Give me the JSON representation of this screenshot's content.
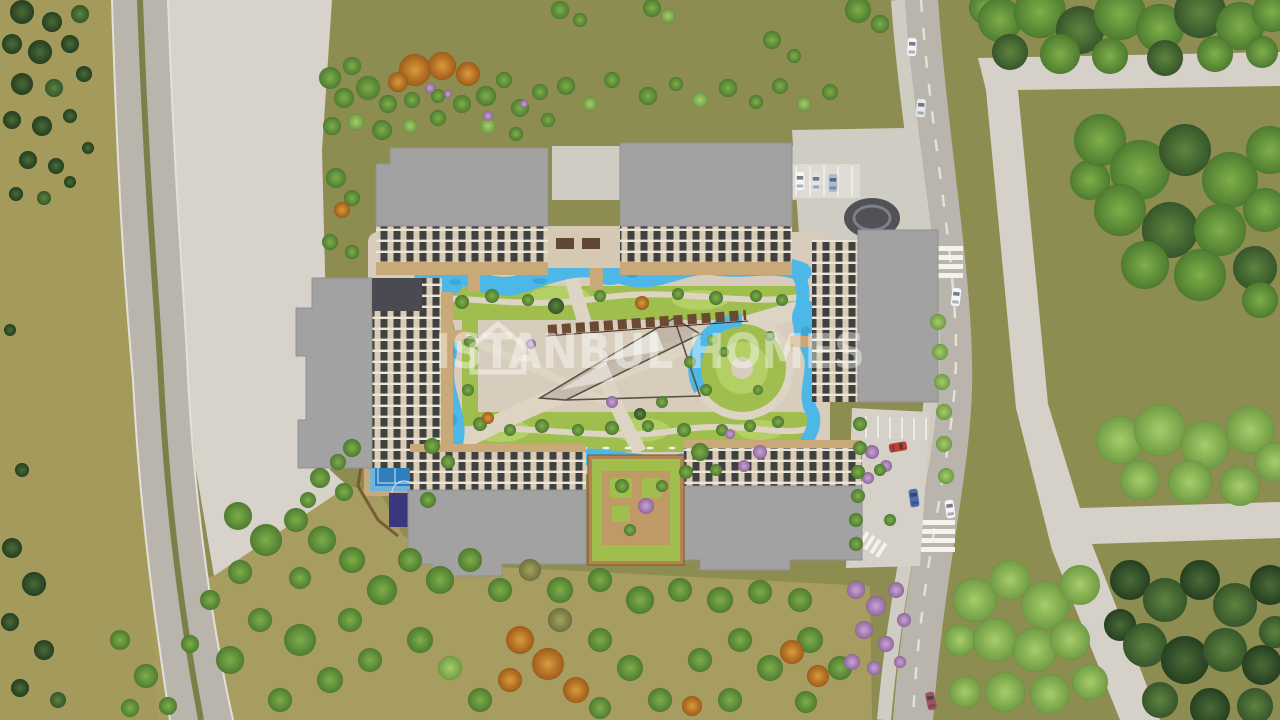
{
  "watermark": {
    "text": "ISTANBUL HOMES",
    "logo": "house-outline-icon"
  },
  "colors": {
    "ground": "#8d8c51",
    "groundLeft": "#a39a5c",
    "groundTan": "#a89d61",
    "plaza": "#d7d3ca",
    "road": "#b9b5ad",
    "roadEdge": "#e3e0d8",
    "median": "#7c7f48",
    "path": "#d5d1c9",
    "pavement": "#cfccc4",
    "parking": "#dedbd3",
    "courtyard": "#d8cdbc",
    "courtPath": "#ddd4c4",
    "lawn": "#9fbe4e",
    "lawnLight": "#b4cf66",
    "pool": "#4db8e8",
    "poolDeep": "#2e8fc4",
    "deck": "#c9a977",
    "roof": "#a2a2a2",
    "roofDark": "#4a4a52",
    "facade": "#d8ccb6",
    "facadeGlass": "#3f4140",
    "slab": "#ece4d4",
    "cabana": "#6a4a32",
    "circleDark": "#515257",
    "tennisOuter": "#6db5dd",
    "tennisInner": "#2f7fbd",
    "sport": "#3a3780",
    "white": "#f4f2ec",
    "wm": "rgba(255,255,255,0.42)"
  },
  "scene": {
    "trees": [
      [
        22,
        12,
        12,
        "c"
      ],
      [
        52,
        22,
        10,
        "c"
      ],
      [
        80,
        14,
        9,
        "dg"
      ],
      [
        12,
        44,
        10,
        "c"
      ],
      [
        40,
        52,
        12,
        "c"
      ],
      [
        70,
        44,
        9,
        "c"
      ],
      [
        22,
        84,
        11,
        "c"
      ],
      [
        54,
        88,
        9,
        "dg"
      ],
      [
        84,
        74,
        8,
        "c"
      ],
      [
        12,
        120,
        9,
        "c"
      ],
      [
        42,
        126,
        10,
        "c"
      ],
      [
        70,
        116,
        7,
        "c"
      ],
      [
        28,
        160,
        9,
        "c"
      ],
      [
        56,
        166,
        8,
        "c"
      ],
      [
        16,
        194,
        7,
        "c"
      ],
      [
        44,
        198,
        7,
        "dg"
      ],
      [
        70,
        182,
        6,
        "c"
      ],
      [
        88,
        148,
        6,
        "c"
      ],
      [
        10,
        330,
        6,
        "c"
      ],
      [
        22,
        470,
        7,
        "c"
      ],
      [
        12,
        548,
        10,
        "c"
      ],
      [
        34,
        584,
        12,
        "c"
      ],
      [
        10,
        622,
        9,
        "c"
      ],
      [
        44,
        650,
        10,
        "c"
      ],
      [
        20,
        688,
        9,
        "c"
      ],
      [
        58,
        700,
        8,
        "dg"
      ],
      [
        120,
        640,
        10,
        "g"
      ],
      [
        146,
        676,
        12,
        "g"
      ],
      [
        130,
        708,
        9,
        "g"
      ],
      [
        168,
        706,
        9,
        "g"
      ],
      [
        415,
        70,
        16,
        "o"
      ],
      [
        442,
        66,
        14,
        "o"
      ],
      [
        468,
        74,
        12,
        "o"
      ],
      [
        398,
        82,
        10,
        "o"
      ],
      [
        330,
        78,
        11,
        "g"
      ],
      [
        352,
        66,
        9,
        "g"
      ],
      [
        344,
        98,
        10,
        "g"
      ],
      [
        368,
        88,
        12,
        "g"
      ],
      [
        388,
        104,
        9,
        "g"
      ],
      [
        412,
        100,
        8,
        "g"
      ],
      [
        438,
        96,
        7,
        "g"
      ],
      [
        332,
        126,
        9,
        "g"
      ],
      [
        356,
        122,
        8,
        "lg"
      ],
      [
        382,
        130,
        10,
        "g"
      ],
      [
        410,
        126,
        7,
        "lg"
      ],
      [
        438,
        118,
        8,
        "g"
      ],
      [
        462,
        104,
        9,
        "g"
      ],
      [
        486,
        96,
        10,
        "g"
      ],
      [
        504,
        80,
        8,
        "g"
      ],
      [
        520,
        108,
        9,
        "g"
      ],
      [
        488,
        126,
        8,
        "lg"
      ],
      [
        516,
        134,
        7,
        "g"
      ],
      [
        540,
        92,
        8,
        "g"
      ],
      [
        548,
        120,
        7,
        "g"
      ],
      [
        430,
        88,
        5,
        "p"
      ],
      [
        448,
        94,
        4,
        "p"
      ],
      [
        488,
        116,
        5,
        "p"
      ],
      [
        524,
        104,
        4,
        "p"
      ],
      [
        566,
        86,
        9,
        "g"
      ],
      [
        590,
        104,
        7,
        "lg"
      ],
      [
        612,
        80,
        8,
        "g"
      ],
      [
        648,
        96,
        9,
        "g"
      ],
      [
        676,
        84,
        7,
        "g"
      ],
      [
        700,
        100,
        8,
        "lg"
      ],
      [
        728,
        88,
        9,
        "g"
      ],
      [
        756,
        102,
        7,
        "g"
      ],
      [
        780,
        86,
        8,
        "g"
      ],
      [
        804,
        104,
        7,
        "lg"
      ],
      [
        830,
        92,
        8,
        "g"
      ],
      [
        560,
        10,
        9,
        "g"
      ],
      [
        580,
        20,
        7,
        "g"
      ],
      [
        652,
        8,
        9,
        "g"
      ],
      [
        668,
        16,
        7,
        "lg"
      ],
      [
        858,
        10,
        13,
        "g"
      ],
      [
        880,
        24,
        9,
        "g"
      ],
      [
        772,
        40,
        9,
        "g"
      ],
      [
        794,
        56,
        7,
        "g"
      ],
      [
        336,
        178,
        10,
        "g"
      ],
      [
        352,
        198,
        8,
        "g"
      ],
      [
        342,
        210,
        8,
        "o"
      ],
      [
        330,
        242,
        8,
        "g"
      ],
      [
        352,
        252,
        7,
        "g"
      ],
      [
        320,
        478,
        10,
        "g"
      ],
      [
        344,
        492,
        9,
        "g"
      ],
      [
        308,
        500,
        8,
        "g"
      ],
      [
        462,
        302,
        7,
        "g"
      ],
      [
        492,
        296,
        7,
        "g"
      ],
      [
        528,
        300,
        6,
        "g"
      ],
      [
        556,
        306,
        8,
        "dg"
      ],
      [
        600,
        296,
        6,
        "g"
      ],
      [
        642,
        303,
        7,
        "o"
      ],
      [
        678,
        294,
        6,
        "g"
      ],
      [
        716,
        298,
        7,
        "g"
      ],
      [
        756,
        296,
        6,
        "g"
      ],
      [
        782,
        300,
        6,
        "g"
      ],
      [
        480,
        424,
        7,
        "g"
      ],
      [
        510,
        430,
        6,
        "g"
      ],
      [
        542,
        426,
        7,
        "g"
      ],
      [
        578,
        430,
        6,
        "g"
      ],
      [
        612,
        428,
        7,
        "g"
      ],
      [
        648,
        426,
        6,
        "g"
      ],
      [
        684,
        430,
        7,
        "g"
      ],
      [
        722,
        430,
        6,
        "g"
      ],
      [
        750,
        426,
        6,
        "g"
      ],
      [
        778,
        422,
        6,
        "g"
      ],
      [
        690,
        362,
        6,
        "g"
      ],
      [
        706,
        390,
        6,
        "g"
      ],
      [
        662,
        402,
        6,
        "g"
      ],
      [
        470,
        342,
        6,
        "g"
      ],
      [
        468,
        390,
        6,
        "g"
      ],
      [
        488,
        418,
        6,
        "o"
      ],
      [
        612,
        402,
        6,
        "p"
      ],
      [
        531,
        344,
        5,
        "p"
      ],
      [
        730,
        434,
        5,
        "p"
      ],
      [
        770,
        336,
        5,
        "g"
      ],
      [
        712,
        340,
        5,
        "lg"
      ],
      [
        640,
        414,
        6,
        "dg"
      ],
      [
        724,
        352,
        5,
        "g"
      ],
      [
        758,
        390,
        5,
        "g"
      ],
      [
        622,
        486,
        7,
        "g"
      ],
      [
        646,
        506,
        8,
        "p"
      ],
      [
        630,
        530,
        6,
        "g"
      ],
      [
        662,
        486,
        6,
        "g"
      ],
      [
        352,
        448,
        9,
        "g"
      ],
      [
        338,
        462,
        8,
        "g"
      ],
      [
        432,
        446,
        8,
        "g"
      ],
      [
        448,
        462,
        7,
        "g"
      ],
      [
        428,
        500,
        8,
        "g"
      ],
      [
        872,
        452,
        7,
        "p"
      ],
      [
        886,
        466,
        6,
        "p"
      ],
      [
        868,
        478,
        6,
        "p"
      ],
      [
        760,
        452,
        7,
        "p"
      ],
      [
        744,
        466,
        6,
        "p"
      ],
      [
        700,
        452,
        9,
        "g"
      ],
      [
        686,
        472,
        7,
        "g"
      ],
      [
        716,
        470,
        6,
        "g"
      ],
      [
        938,
        322,
        8,
        "lg"
      ],
      [
        940,
        352,
        8,
        "lg"
      ],
      [
        942,
        382,
        8,
        "lg"
      ],
      [
        944,
        412,
        8,
        "lg"
      ],
      [
        944,
        444,
        8,
        "lg"
      ],
      [
        946,
        476,
        8,
        "lg"
      ],
      [
        860,
        424,
        7,
        "g"
      ],
      [
        860,
        448,
        7,
        "g"
      ],
      [
        858,
        472,
        7,
        "g"
      ],
      [
        858,
        496,
        7,
        "g"
      ],
      [
        856,
        520,
        7,
        "g"
      ],
      [
        856,
        544,
        7,
        "g"
      ],
      [
        880,
        470,
        6,
        "g"
      ],
      [
        890,
        520,
        6,
        "g"
      ],
      [
        238,
        516,
        14,
        "g"
      ],
      [
        266,
        540,
        16,
        "g"
      ],
      [
        240,
        572,
        12,
        "g"
      ],
      [
        296,
        520,
        12,
        "g"
      ],
      [
        322,
        540,
        14,
        "g"
      ],
      [
        300,
        578,
        11,
        "g"
      ],
      [
        352,
        560,
        13,
        "g"
      ],
      [
        382,
        590,
        15,
        "g"
      ],
      [
        350,
        620,
        12,
        "g"
      ],
      [
        410,
        560,
        12,
        "g"
      ],
      [
        440,
        580,
        14,
        "g"
      ],
      [
        470,
        560,
        12,
        "g"
      ],
      [
        300,
        640,
        16,
        "g"
      ],
      [
        260,
        620,
        12,
        "g"
      ],
      [
        230,
        660,
        14,
        "g"
      ],
      [
        330,
        680,
        13,
        "g"
      ],
      [
        370,
        660,
        12,
        "g"
      ],
      [
        280,
        700,
        12,
        "g"
      ],
      [
        420,
        640,
        13,
        "g"
      ],
      [
        450,
        668,
        12,
        "lg"
      ],
      [
        500,
        590,
        12,
        "g"
      ],
      [
        530,
        570,
        11,
        "k"
      ],
      [
        560,
        590,
        13,
        "g"
      ],
      [
        600,
        580,
        12,
        "g"
      ],
      [
        640,
        600,
        14,
        "g"
      ],
      [
        680,
        590,
        12,
        "g"
      ],
      [
        720,
        600,
        13,
        "g"
      ],
      [
        760,
        592,
        12,
        "g"
      ],
      [
        800,
        600,
        12,
        "g"
      ],
      [
        560,
        620,
        12,
        "k"
      ],
      [
        520,
        640,
        14,
        "o"
      ],
      [
        548,
        664,
        16,
        "o"
      ],
      [
        576,
        690,
        13,
        "o"
      ],
      [
        510,
        680,
        12,
        "o"
      ],
      [
        480,
        700,
        12,
        "g"
      ],
      [
        600,
        640,
        12,
        "g"
      ],
      [
        630,
        668,
        13,
        "g"
      ],
      [
        660,
        700,
        12,
        "g"
      ],
      [
        700,
        660,
        12,
        "g"
      ],
      [
        740,
        640,
        12,
        "g"
      ],
      [
        770,
        668,
        13,
        "g"
      ],
      [
        692,
        706,
        10,
        "o"
      ],
      [
        730,
        700,
        12,
        "g"
      ],
      [
        810,
        640,
        13,
        "g"
      ],
      [
        840,
        668,
        12,
        "g"
      ],
      [
        806,
        702,
        11,
        "g"
      ],
      [
        600,
        708,
        11,
        "g"
      ],
      [
        210,
        600,
        10,
        "g"
      ],
      [
        190,
        644,
        9,
        "g"
      ],
      [
        792,
        652,
        12,
        "o"
      ],
      [
        818,
        676,
        11,
        "o"
      ],
      [
        856,
        590,
        9,
        "p"
      ],
      [
        876,
        606,
        10,
        "p"
      ],
      [
        896,
        590,
        8,
        "p"
      ],
      [
        864,
        630,
        9,
        "p"
      ],
      [
        886,
        644,
        8,
        "p"
      ],
      [
        904,
        620,
        7,
        "p"
      ],
      [
        852,
        662,
        8,
        "p"
      ],
      [
        874,
        668,
        7,
        "p"
      ],
      [
        900,
        662,
        6,
        "p"
      ],
      [
        985,
        8,
        16,
        "g"
      ],
      [
        1000,
        20,
        22,
        "g"
      ],
      [
        1040,
        12,
        26,
        "g"
      ],
      [
        1080,
        30,
        24,
        "dg"
      ],
      [
        1120,
        14,
        26,
        "g"
      ],
      [
        1160,
        28,
        24,
        "g"
      ],
      [
        1200,
        12,
        26,
        "dg"
      ],
      [
        1240,
        26,
        24,
        "g"
      ],
      [
        1272,
        12,
        20,
        "g"
      ],
      [
        1010,
        52,
        18,
        "dg"
      ],
      [
        1060,
        54,
        20,
        "g"
      ],
      [
        1110,
        56,
        18,
        "g"
      ],
      [
        1165,
        58,
        18,
        "dg"
      ],
      [
        1215,
        54,
        18,
        "g"
      ],
      [
        1262,
        52,
        16,
        "g"
      ],
      [
        1090,
        180,
        20,
        "g"
      ],
      [
        1100,
        140,
        26,
        "g"
      ],
      [
        1140,
        170,
        30,
        "g"
      ],
      [
        1185,
        150,
        26,
        "dg"
      ],
      [
        1230,
        180,
        28,
        "g"
      ],
      [
        1270,
        150,
        24,
        "g"
      ],
      [
        1120,
        210,
        26,
        "g"
      ],
      [
        1170,
        230,
        28,
        "dg"
      ],
      [
        1220,
        230,
        26,
        "g"
      ],
      [
        1265,
        210,
        22,
        "g"
      ],
      [
        1145,
        265,
        24,
        "g"
      ],
      [
        1200,
        275,
        26,
        "g"
      ],
      [
        1255,
        268,
        22,
        "dg"
      ],
      [
        1260,
        300,
        18,
        "g"
      ],
      [
        1120,
        440,
        24,
        "lg"
      ],
      [
        1160,
        430,
        26,
        "lg"
      ],
      [
        1205,
        445,
        24,
        "lg"
      ],
      [
        1250,
        430,
        24,
        "lg"
      ],
      [
        1275,
        462,
        20,
        "lg"
      ],
      [
        1140,
        480,
        20,
        "lg"
      ],
      [
        1190,
        482,
        22,
        "lg"
      ],
      [
        1240,
        486,
        20,
        "lg"
      ],
      [
        1120,
        625,
        16,
        "c"
      ],
      [
        1130,
        580,
        20,
        "c"
      ],
      [
        1165,
        600,
        22,
        "dg"
      ],
      [
        1200,
        580,
        20,
        "c"
      ],
      [
        1235,
        605,
        22,
        "dg"
      ],
      [
        1270,
        585,
        20,
        "c"
      ],
      [
        1145,
        645,
        22,
        "dg"
      ],
      [
        1185,
        660,
        24,
        "c"
      ],
      [
        1225,
        650,
        22,
        "dg"
      ],
      [
        1262,
        665,
        20,
        "c"
      ],
      [
        1160,
        700,
        18,
        "dg"
      ],
      [
        1210,
        708,
        20,
        "c"
      ],
      [
        1255,
        706,
        18,
        "dg"
      ],
      [
        1275,
        632,
        16,
        "dg"
      ],
      [
        960,
        640,
        16,
        "lg"
      ],
      [
        975,
        600,
        22,
        "lg"
      ],
      [
        1010,
        580,
        20,
        "lg"
      ],
      [
        1045,
        605,
        24,
        "lg"
      ],
      [
        1080,
        585,
        20,
        "lg"
      ],
      [
        995,
        640,
        22,
        "lg"
      ],
      [
        1035,
        650,
        22,
        "lg"
      ],
      [
        1070,
        640,
        20,
        "lg"
      ],
      [
        1005,
        692,
        20,
        "lg"
      ],
      [
        1050,
        694,
        20,
        "lg"
      ],
      [
        1090,
        682,
        18,
        "lg"
      ],
      [
        965,
        692,
        16,
        "lg"
      ]
    ],
    "cars": [
      [
        912,
        47,
        3,
        "#f2f4f6"
      ],
      [
        921,
        108,
        4,
        "#e8ebee"
      ],
      [
        956,
        297,
        6,
        "#f4f6f8"
      ],
      [
        898,
        447,
        80,
        "#c04038"
      ],
      [
        914,
        498,
        -8,
        "#4a6cae"
      ],
      [
        950,
        509,
        -8,
        "#f2f4f6"
      ],
      [
        931,
        701,
        -12,
        "#9c5560"
      ],
      [
        800,
        181,
        0,
        "#f4f6f8"
      ],
      [
        816,
        182,
        0,
        "#dfe3e7"
      ],
      [
        833,
        183,
        0,
        "#a8bdd2"
      ]
    ]
  }
}
